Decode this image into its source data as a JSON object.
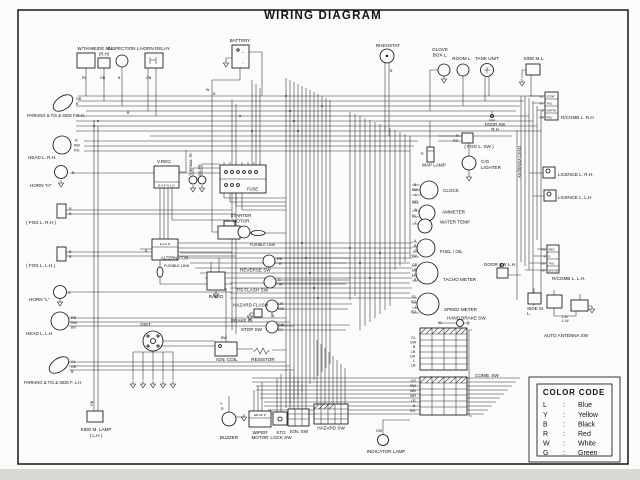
{
  "title": "WIRING DIAGRAM",
  "labels": {
    "w_tank": "W/TANK",
    "side_ml_rh": "SIDE M.L.",
    "side_ml_rh_sub": "(R.H)",
    "inspection": "INSPECTION L.",
    "horn_relay": "HORN RELAY",
    "battery": "BATTERY",
    "rheostat": "RHEOSTAT",
    "glove_1": "GLOVE",
    "glove_2": "BOX L.",
    "room_l": "ROOM L.",
    "tank_unit": "TANK UNIT",
    "side_ml_top": "SIDE M.L.",
    "rcomb_rh": "R/COMB L. R.H",
    "door_sw_rh_1": "DOOR SW",
    "door_sw_rh_2": "R.H",
    "fog_l_sw": "( FOG L. SW )",
    "cg_1": "C/G",
    "cg_2": "LIGHTER",
    "map_lamp": "MAP LAMP",
    "licence_rh": "LICENCE L. R.H.",
    "licence_lh": "LICENCE L. L.H",
    "antenna_lead": "ANTENNA LEAD",
    "clock": "CLOCK",
    "ammeter": "AMMETER",
    "water_temp": "WATER TEMP",
    "fuel_oil": "FUEL / OIL",
    "tacho": "TACHO METER",
    "speed": "SPEED METER",
    "hand_brake": "HAND BRAKE SW.",
    "door_sw_lh": "DOOR SW L.H.",
    "rcomb_lh": "R/COMB L. L.H.",
    "side_ml_bot_1": "SIDE M.",
    "side_ml_bot_2": "L.",
    "auto_antenna": "AUTO ANTENNA SW",
    "comb_sw": "COMB. SW",
    "parking_rh": "PARKING & T/S & SIDE F.R.H.",
    "head_rh": "HEAD L. R.H.",
    "horn_h": "HORN \"H\"",
    "fog_rh": "( FOG L. R.H )",
    "fog_lh": "( FOG L. L.H.)",
    "horn_l": "HORN \"L\"",
    "head_lh": "HEAD L. L.H",
    "parking_lh": "PARKING & T/S & SIDE F. L.H",
    "side_m_lamp_1": "SIDE M. LAMP",
    "side_m_lamp_2": "( L.H )",
    "v_reg": "V.REG.",
    "thermal_tr": "THERMAL TR.",
    "oil_pr": "OIL PR.",
    "fuse": "FUSE",
    "starter_1": "STARTER",
    "starter_2": "MOTOR",
    "fusible_link_a": "FUSIBLE LINK",
    "alternator": "ALTERNATOR",
    "fusible_link_b": "FUSIBLE LINK",
    "radio": "RADIO",
    "reverse_sw": "REVERSE SW",
    "ts_flash_sw": "T/S FLASH SW",
    "hazard_flash": "HAZARD FLASH",
    "brake_in": "BRAKE IN",
    "stop_sw": "STOP SW",
    "dist": "DIST.",
    "ign_coil": "IGN. COIL",
    "resistor": "RESISTOR",
    "buzzer": "BUZZER",
    "wiper_1": "WIPER",
    "wiper_2": "MOTOR",
    "stg_1": "STG",
    "stg_2": "LOCK SW",
    "ign_sw": "IGN. SW",
    "hazard_sw": "HAZARD SW",
    "indicator": "INDICATOR LAMP"
  },
  "terminals": {
    "vreg": "E A F N L G",
    "alt": "E A F N",
    "wiper": "EB AF P",
    "batt_plus": "+",
    "batt_minus": "−"
  },
  "rcomb_rh": {
    "rows": [
      {
        "c": "GB",
        "f": "STOP"
      },
      {
        "c": "GR",
        "f": "TAIL"
      },
      {
        "c": "B",
        "f": "EARTH"
      },
      {
        "c": "RB",
        "f": "REV"
      }
    ]
  },
  "rcomb_lh": {
    "rows": [
      {
        "c": "RB",
        "f": "REV"
      },
      {
        "c": "B",
        "f": "E"
      },
      {
        "c": "GW",
        "f": "TAIL"
      },
      {
        "c": "GR",
        "f": "B/STOP"
      }
    ]
  },
  "codes": [
    "GB",
    "B",
    "R",
    "RW",
    "RG",
    "B",
    "R",
    "B",
    "B",
    "R",
    "G",
    "RB",
    "RW",
    "RY",
    "GL",
    "GR",
    "B",
    "GB",
    "RL",
    "GB",
    "B",
    "GB",
    "B",
    "W",
    "B",
    "R",
    "R",
    "RG",
    "B",
    "RW",
    "L",
    "WR",
    "W",
    "RL",
    "Y",
    "Y",
    "B",
    "G",
    "YW",
    "GB",
    "LB",
    "LG",
    "B",
    "RL",
    "RG",
    "L",
    "RG",
    "YL",
    "GL",
    "GW",
    "B",
    "LB",
    "LW",
    "L",
    "LB",
    "GY",
    "RW",
    "WB",
    "WR",
    "LR",
    "B",
    "RG",
    "RB",
    "R",
    "G",
    "W",
    "LW",
    "GW",
    "YL",
    "GW",
    "GY",
    "BW",
    "Y",
    "R",
    "GW",
    "L-B",
    "L-W",
    "B",
    "B"
  ],
  "color_code": {
    "title": "COLOR CODE",
    "colon": ":",
    "rows": [
      {
        "k": "L",
        "v": "Blue"
      },
      {
        "k": "Y",
        "v": "Yellow"
      },
      {
        "k": "B",
        "v": "Black"
      },
      {
        "k": "R",
        "v": "Red"
      },
      {
        "k": "W",
        "v": "White"
      },
      {
        "k": "G",
        "v": "Green"
      }
    ]
  }
}
